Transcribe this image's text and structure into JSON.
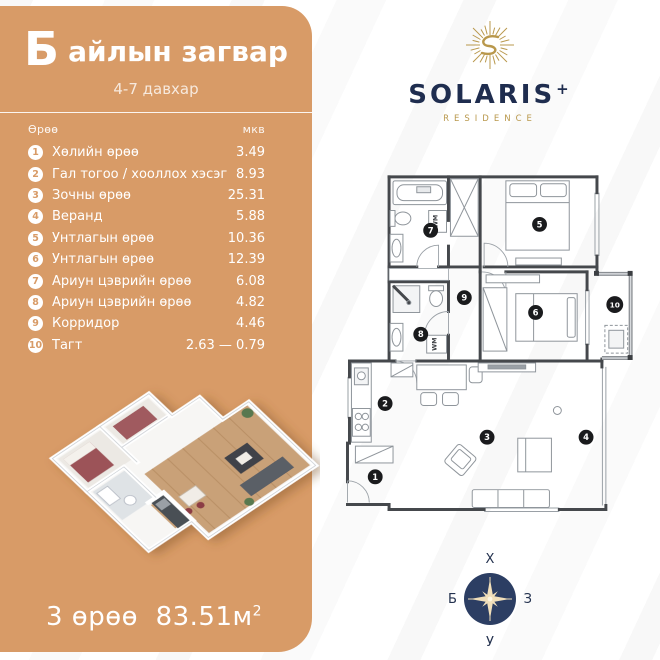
{
  "colors": {
    "accent_tan": "#D89B67",
    "brand_navy": "#1F2D4F",
    "brand_gold": "#B9984C",
    "compass_navy": "#2C3E63",
    "compass_star": "#F1DFBA",
    "plan_wall": "#45484C"
  },
  "left_panel": {
    "title_letter": "Б",
    "title_rest": "айлын загвар",
    "subtitle": "4-7 давхар",
    "table": {
      "col_room": "Өрөө",
      "col_area": "мкв",
      "rows": [
        {
          "num": "1",
          "name": "Хөлийн өрөө",
          "area": "3.49"
        },
        {
          "num": "2",
          "name": "Гал тогоо / хооллох хэсэг",
          "area": "8.93"
        },
        {
          "num": "3",
          "name": "Зочны өрөө",
          "area": "25.31"
        },
        {
          "num": "4",
          "name": "Веранд",
          "area": "5.88"
        },
        {
          "num": "5",
          "name": "Унтлагын өрөө",
          "area": "10.36"
        },
        {
          "num": "6",
          "name": "Унтлагын өрөө",
          "area": "12.39"
        },
        {
          "num": "7",
          "name": "Ариун цэврийн өрөө",
          "area": "6.08"
        },
        {
          "num": "8",
          "name": "Ариун цэврийн өрөө",
          "area": "4.82"
        },
        {
          "num": "9",
          "name": "Корридор",
          "area": "4.46"
        },
        {
          "num": "10",
          "name": "Тагт",
          "area": "2.63 — 0.79"
        }
      ]
    },
    "summary_rooms": "3 өрөө",
    "summary_area": "83.51м",
    "summary_sup": "2"
  },
  "brand": {
    "name": "SOLARIS",
    "plus": "+",
    "residence": "RESIDENCE"
  },
  "floorplan": {
    "wm_label": "WM",
    "badges": [
      "1",
      "2",
      "3",
      "4",
      "5",
      "6",
      "7",
      "8",
      "9",
      "10"
    ]
  },
  "compass": {
    "north": "Х",
    "south": "У",
    "west": "Б",
    "east": "З"
  }
}
